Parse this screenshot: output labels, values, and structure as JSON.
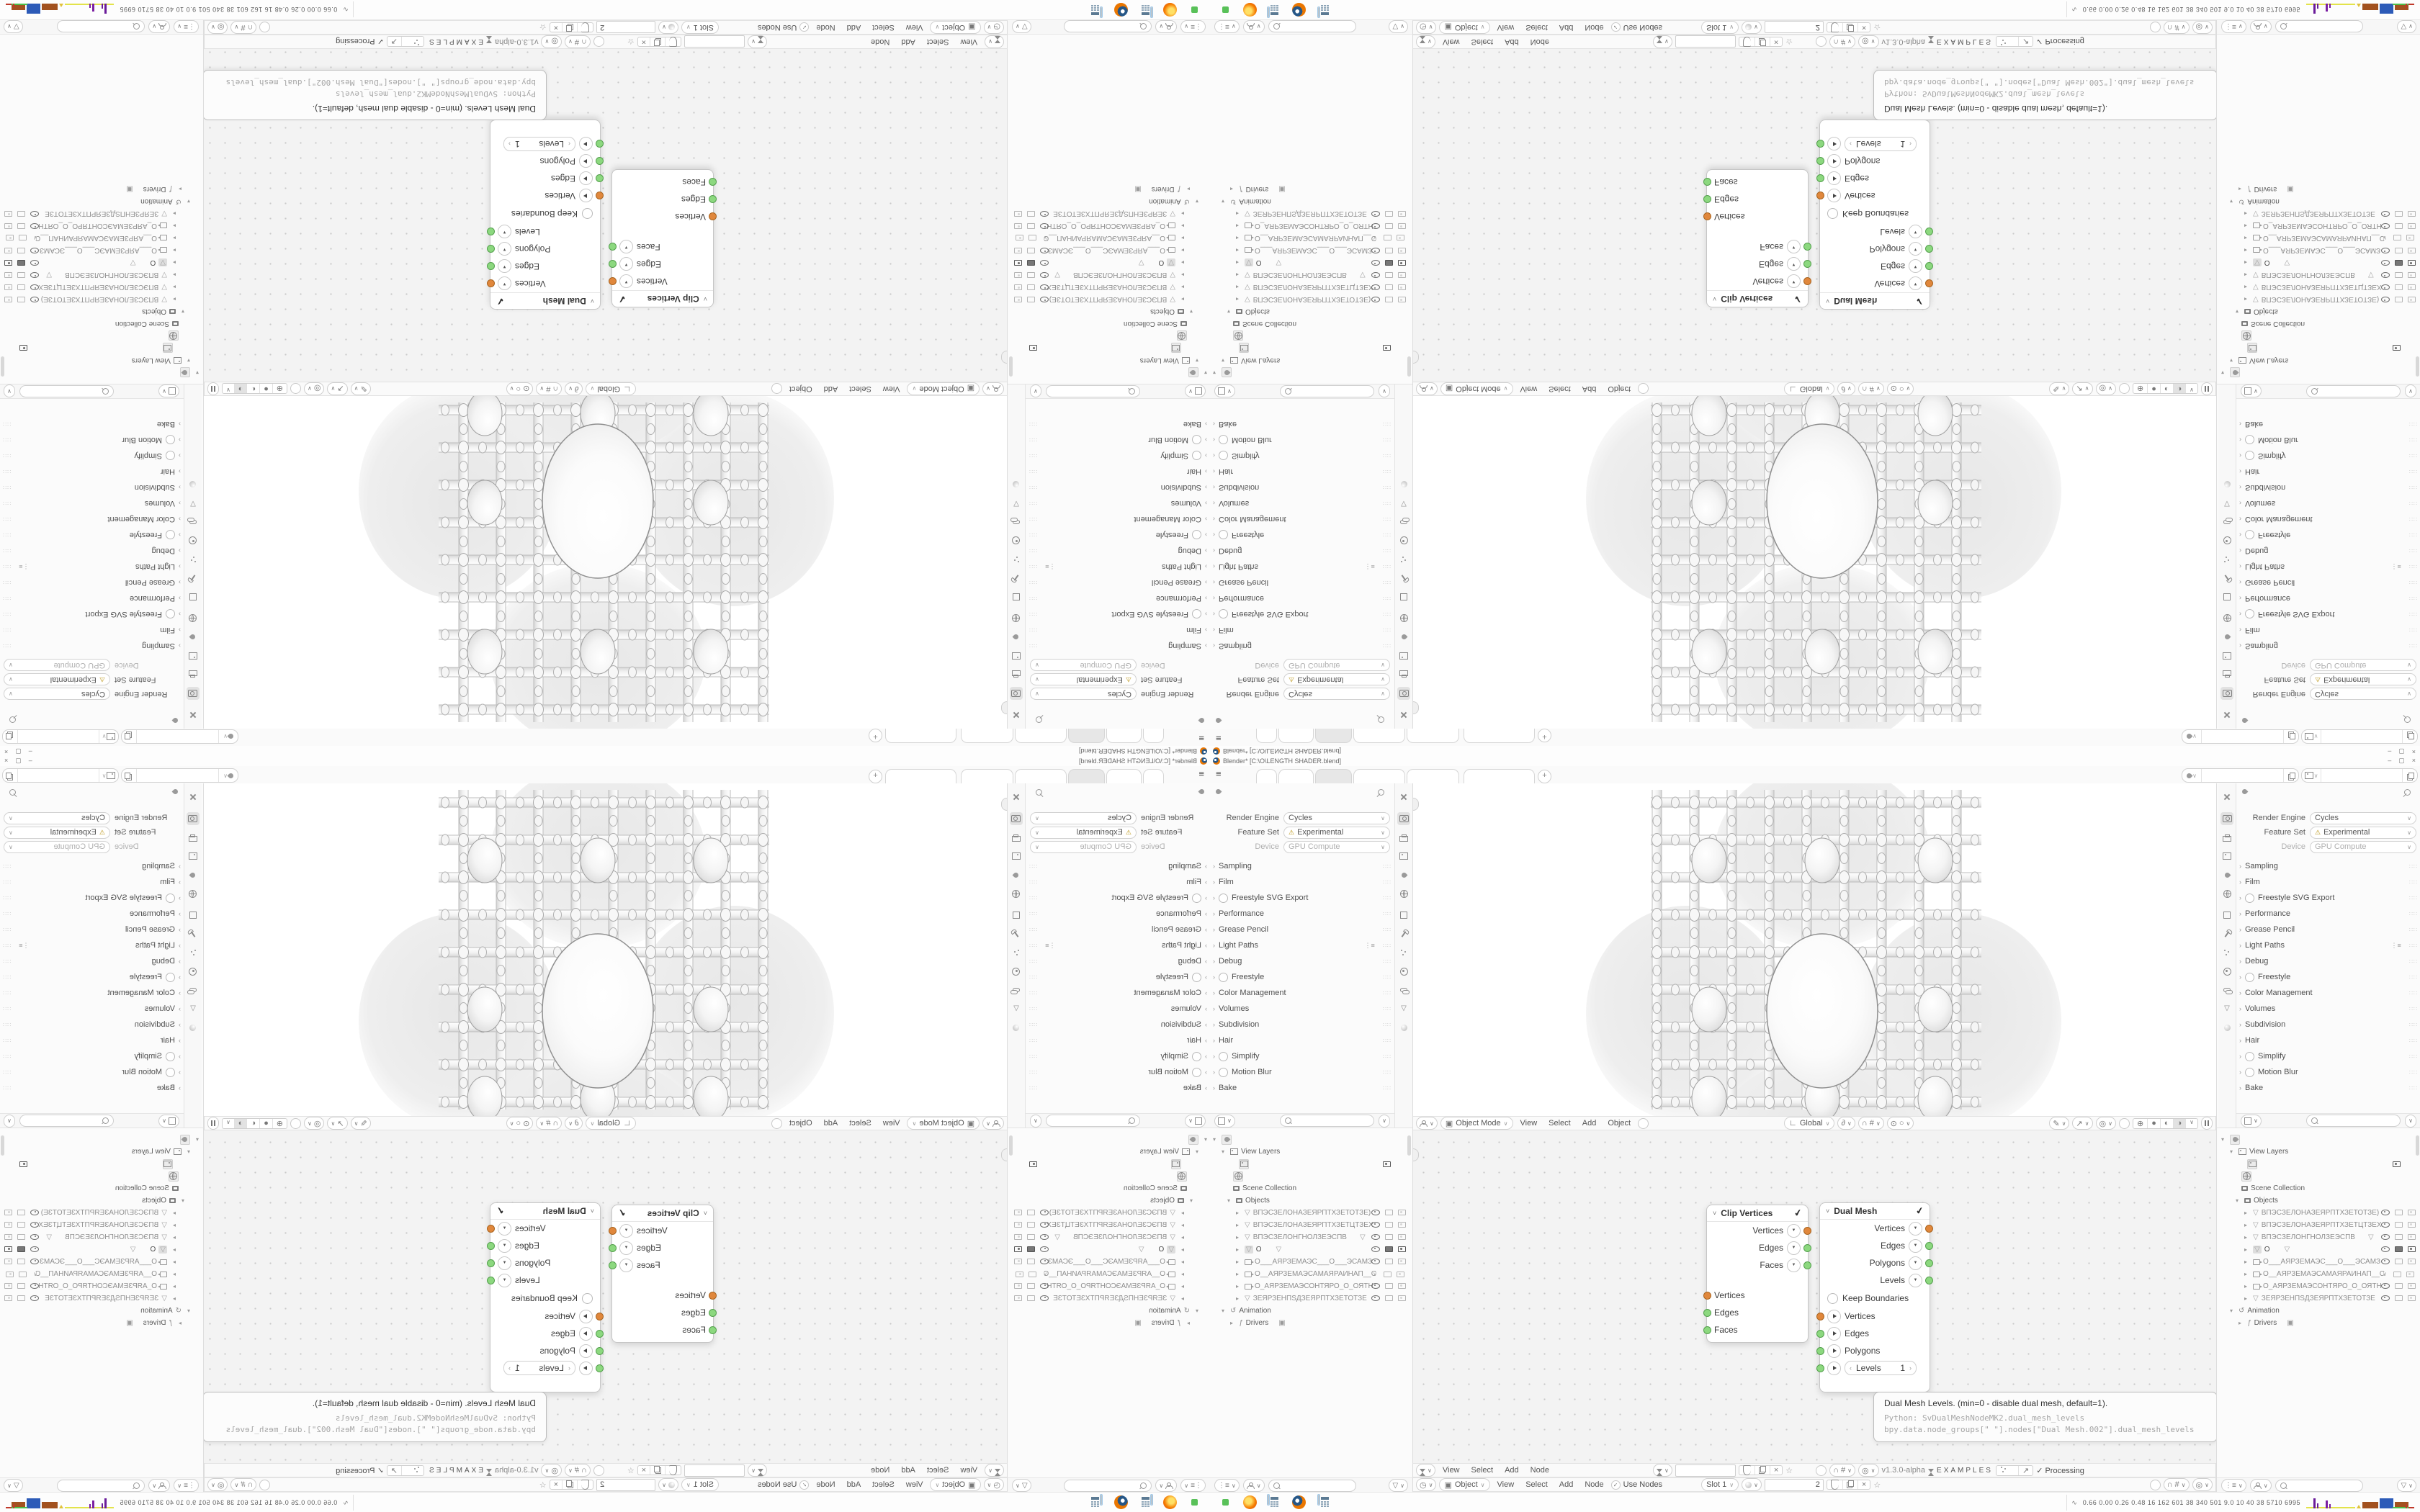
{
  "icons": {
    "hamburger": "≡",
    "plus": "+",
    "dropdown": "∨",
    "chevron_right": "›",
    "header_chevron": "˅",
    "tri_down": "▾",
    "tri_right": "▸",
    "sock_menu": "▼",
    "step_left": "‹",
    "step_right": "›",
    "grip": "∷∷",
    "list_preset": "⋮≡",
    "mesh": "▽",
    "filter": "▽",
    "check": "✓",
    "warn": "⚠",
    "star": "☆",
    "close": "×",
    "minimize": "–",
    "maximize": "▢",
    "clock": "◷",
    "anim": "↺",
    "driver": "ƒ",
    "falloff": "∂",
    "axis": "∟",
    "magnet": "∩",
    "snap_grid": "#",
    "prop_on": "⊙",
    "prop_off": "○",
    "annotate": "✎",
    "gizmo": "↗",
    "overlay": "◎",
    "shade_wire": "⊕",
    "shade_solid": "●",
    "shade_material": "◐",
    "shade_rendered": "◑",
    "eye_closed": "∨",
    "perf_glyph": "∿",
    "node_glyph": "✔",
    "box": "▣"
  },
  "window": {
    "title": "Blender* [C:\\O\\LENGTH SHADER.blend]"
  },
  "viewport": {
    "mode": "Object Mode",
    "menu_view": "View",
    "menu_select": "Select",
    "menu_add": "Add",
    "menu_object": "Object",
    "orientation": "Global"
  },
  "properties": {
    "render_engine_label": "Render Engine",
    "render_engine": "Cycles",
    "feature_set_label": "Feature Set",
    "feature_set": "Experimental",
    "device_label": "Device",
    "device": "GPU Compute",
    "sections": [
      {
        "label": "Sampling"
      },
      {
        "label": "Film"
      },
      {
        "label": "Freestyle SVG Export"
      },
      {
        "label": "Performance"
      },
      {
        "label": "Grease Pencil"
      },
      {
        "label": "Light Paths"
      },
      {
        "label": "Debug"
      },
      {
        "label": "Freestyle"
      },
      {
        "label": "Color Management"
      },
      {
        "label": "Volumes"
      },
      {
        "label": "Subdivision"
      },
      {
        "label": "Hair"
      },
      {
        "label": "Simplify"
      },
      {
        "label": "Motion Blur"
      },
      {
        "label": "Bake"
      }
    ]
  },
  "outliner": {
    "view_layers": "View Layers",
    "scene_collection": "Scene Collection",
    "objects_label": "Objects",
    "animation": "Animation",
    "drivers": "Drivers",
    "objects": [
      {
        "name": "ВПЭСЗЕЛОНАЗЕЯРПТХЗЕТОТЗЕ)"
      },
      {
        "name": "ВПЭСЗЕЛОНАЗЕЯРПТХЗЕТЦТЗЕХ"
      },
      {
        "name": "ВПЭСЗЕЛОНГНОЛЗЕЭСПВ"
      },
      {
        "name": "O"
      },
      {
        "name": "О___АЯРЗЕМАЭС___О___ЭСАМЗ"
      },
      {
        "name": "О__АЯРЗЕМАЭСАМАЯРАИНАП__С"
      },
      {
        "name": "О_АЯРЗЕМАЭСОНТЯРО_О_ОЯТН"
      },
      {
        "name": "ЗЕЯРЗЕНПЅДЗЕЯРПТХЗЕТОТЗЕ"
      }
    ]
  },
  "node_editor": {
    "clip_node": {
      "title": "Clip Vertices",
      "out1": "Vertices",
      "out2": "Edges",
      "out3": "Faces",
      "in1": "Vertices",
      "in2": "Edges",
      "in3": "Faces"
    },
    "dual_node": {
      "title": "Dual Mesh",
      "out1": "Vertices",
      "out2": "Edges",
      "out3": "Polygons",
      "out4": "Levels",
      "checkbox": "Keep Boundaries",
      "in1": "Vertices",
      "in2": "Edges",
      "in3": "Polygons",
      "levels_label": "Levels",
      "levels_value": "1"
    },
    "tooltip_line1": "Dual Mesh Levels. (min=0 - disable dual mesh, default=1).",
    "tooltip_line2": "Python: SvDualMeshNodeMK2.dual_mesh_levels",
    "tooltip_line3": "bpy.data.node_groups[\" \"].nodes[\"Dual Mesh.002\"].dual_mesh_levels",
    "sv": {
      "menu_view": "View",
      "menu_select": "Select",
      "menu_add": "Add",
      "menu_node": "Node",
      "tree_name": "",
      "version": "v1.3.0-alpha",
      "examples": "EXAMPLES",
      "processing": "Processing"
    },
    "shader": {
      "object": "Object",
      "menu_view": "View",
      "menu_select": "Select",
      "menu_add": "Add",
      "menu_node": "Node",
      "use_nodes": "Use Nodes",
      "slot": "Slot 1",
      "material_name": "2"
    }
  },
  "taskbar": {
    "perf_stats": "0.66 0.00 0.26 0.48  16  162  601  38  340  501  9.0  10  40  38  5710 6995"
  }
}
